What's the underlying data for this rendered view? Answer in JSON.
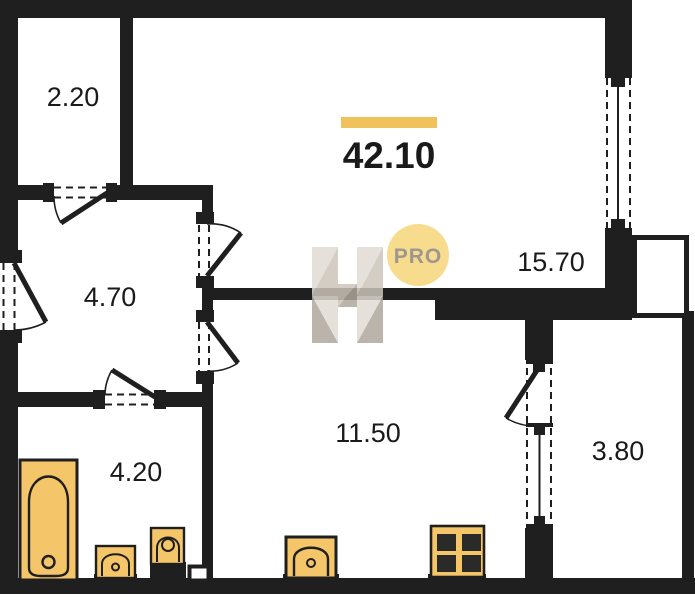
{
  "plan": {
    "total_area": {
      "value": "42.10"
    },
    "rooms": [
      {
        "id": "loggia-top",
        "area": "2.20"
      },
      {
        "id": "hallway",
        "area": "4.70"
      },
      {
        "id": "living-room",
        "area": "15.70"
      },
      {
        "id": "kitchen",
        "area": "11.50"
      },
      {
        "id": "bathroom",
        "area": "4.20"
      },
      {
        "id": "balcony-right",
        "area": "3.80"
      }
    ],
    "fixtures": [
      {
        "name": "bathtub"
      },
      {
        "name": "washbasin"
      },
      {
        "name": "toilet"
      },
      {
        "name": "kitchen-sink"
      },
      {
        "name": "stove"
      }
    ]
  },
  "watermark": {
    "badge": "PRO"
  },
  "colors": {
    "wall": "#1F1F1F",
    "fixture_fill": "#F5C56A",
    "accent_bar": "#EFC25C",
    "badge_fill": "#F8DC8D",
    "badge_text": "#9D978F",
    "label_text": "#1A1A1A",
    "watermark_light": "#E0DBD3",
    "watermark_mid": "#CBC4BA",
    "watermark_dark": "#AFA79C"
  }
}
